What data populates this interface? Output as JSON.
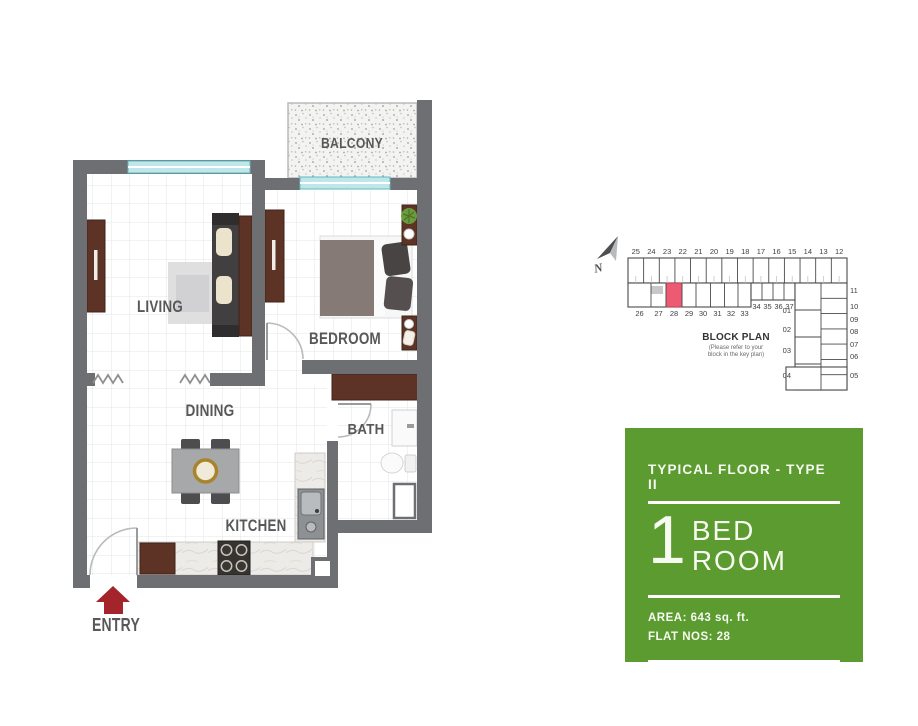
{
  "floor_plan": {
    "rooms": {
      "balcony": "BALCONY",
      "living": "LIVING",
      "bedroom": "BEDROOM",
      "dining": "DINING",
      "bath": "BATH",
      "kitchen": "KITCHEN"
    },
    "entry_label": "ENTRY"
  },
  "block_plan": {
    "title": "BLOCK PLAN",
    "caption_line1": "(Please refer to your",
    "caption_line2": "block in the key plan)",
    "north_label": "N",
    "top_row_units": [
      "25",
      "24",
      "23",
      "22",
      "21",
      "20",
      "19",
      "18",
      "17",
      "16",
      "15",
      "14",
      "13",
      "12"
    ],
    "second_row_units": [
      "26",
      "27",
      "28",
      "29",
      "30",
      "31",
      "32",
      "33",
      "34",
      "35",
      "36",
      "37"
    ],
    "left_column_units": [
      "01",
      "02",
      "03",
      "04"
    ],
    "right_column_units": [
      "11",
      "10",
      "09",
      "08",
      "07",
      "06",
      "05"
    ],
    "highlighted_unit": "28",
    "highlight_color": "#ee5a74"
  },
  "info_panel": {
    "title": "TYPICAL FLOOR - TYPE II",
    "bedroom_count": "1",
    "type_line1": "BED",
    "type_line2": "ROOM",
    "area_label": "AREA: 643 sq. ft.",
    "flat_label": "FLAT NOS: 28",
    "background_color": "#5b9b30"
  },
  "colors": {
    "wall": "#6e6f72",
    "window_glass": "#bfe7ea",
    "wood": "#5c3325",
    "entry_arrow": "#a3242a",
    "room_label": "#58585a"
  }
}
